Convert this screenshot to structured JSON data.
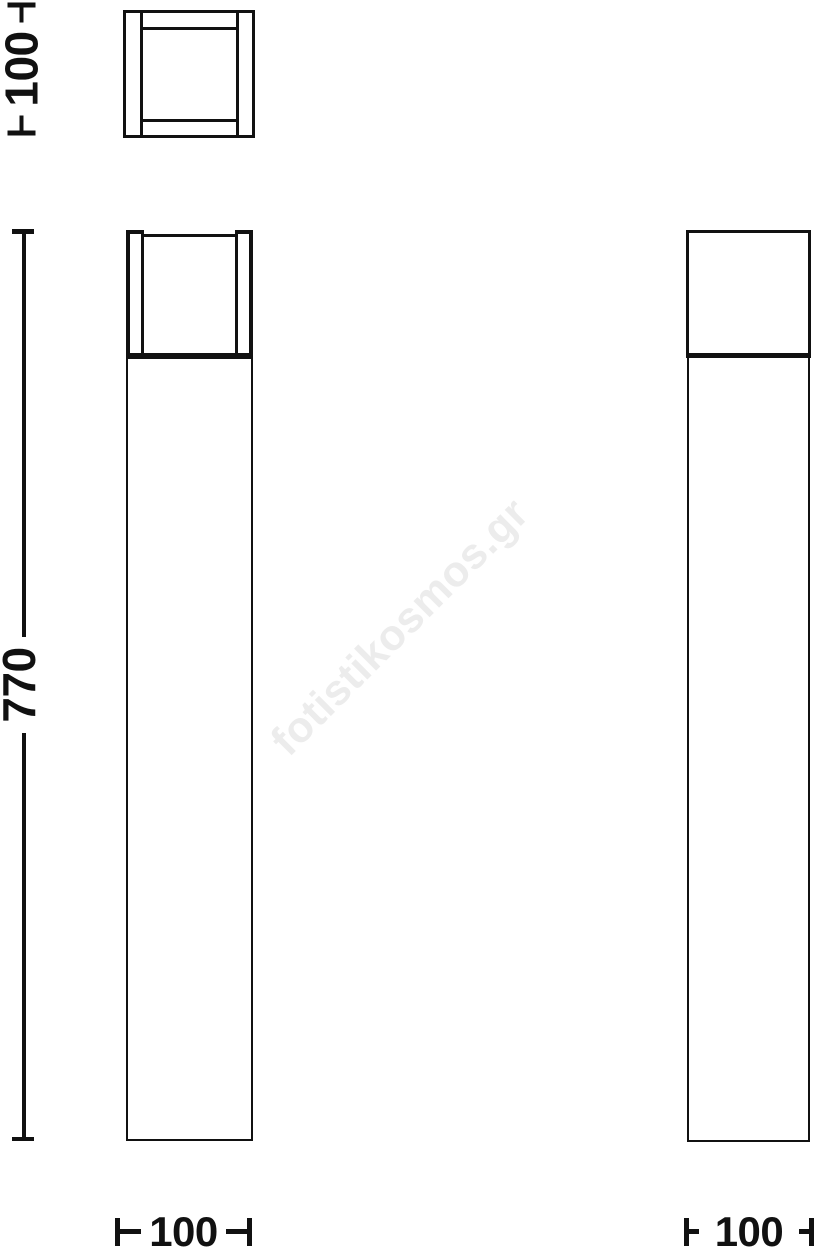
{
  "watermark": {
    "text": "fotistikosmos.gr",
    "color": "#ececec"
  },
  "dimensions": {
    "plan_depth": {
      "value": "100",
      "orientation": "vertical"
    },
    "height": {
      "value": "770",
      "orientation": "vertical"
    },
    "front_width": {
      "value": "100",
      "orientation": "horizontal"
    },
    "side_width": {
      "value": "100",
      "orientation": "horizontal"
    }
  },
  "colors": {
    "line": "#111111",
    "watermark": "#ececec",
    "background": "#ffffff"
  }
}
